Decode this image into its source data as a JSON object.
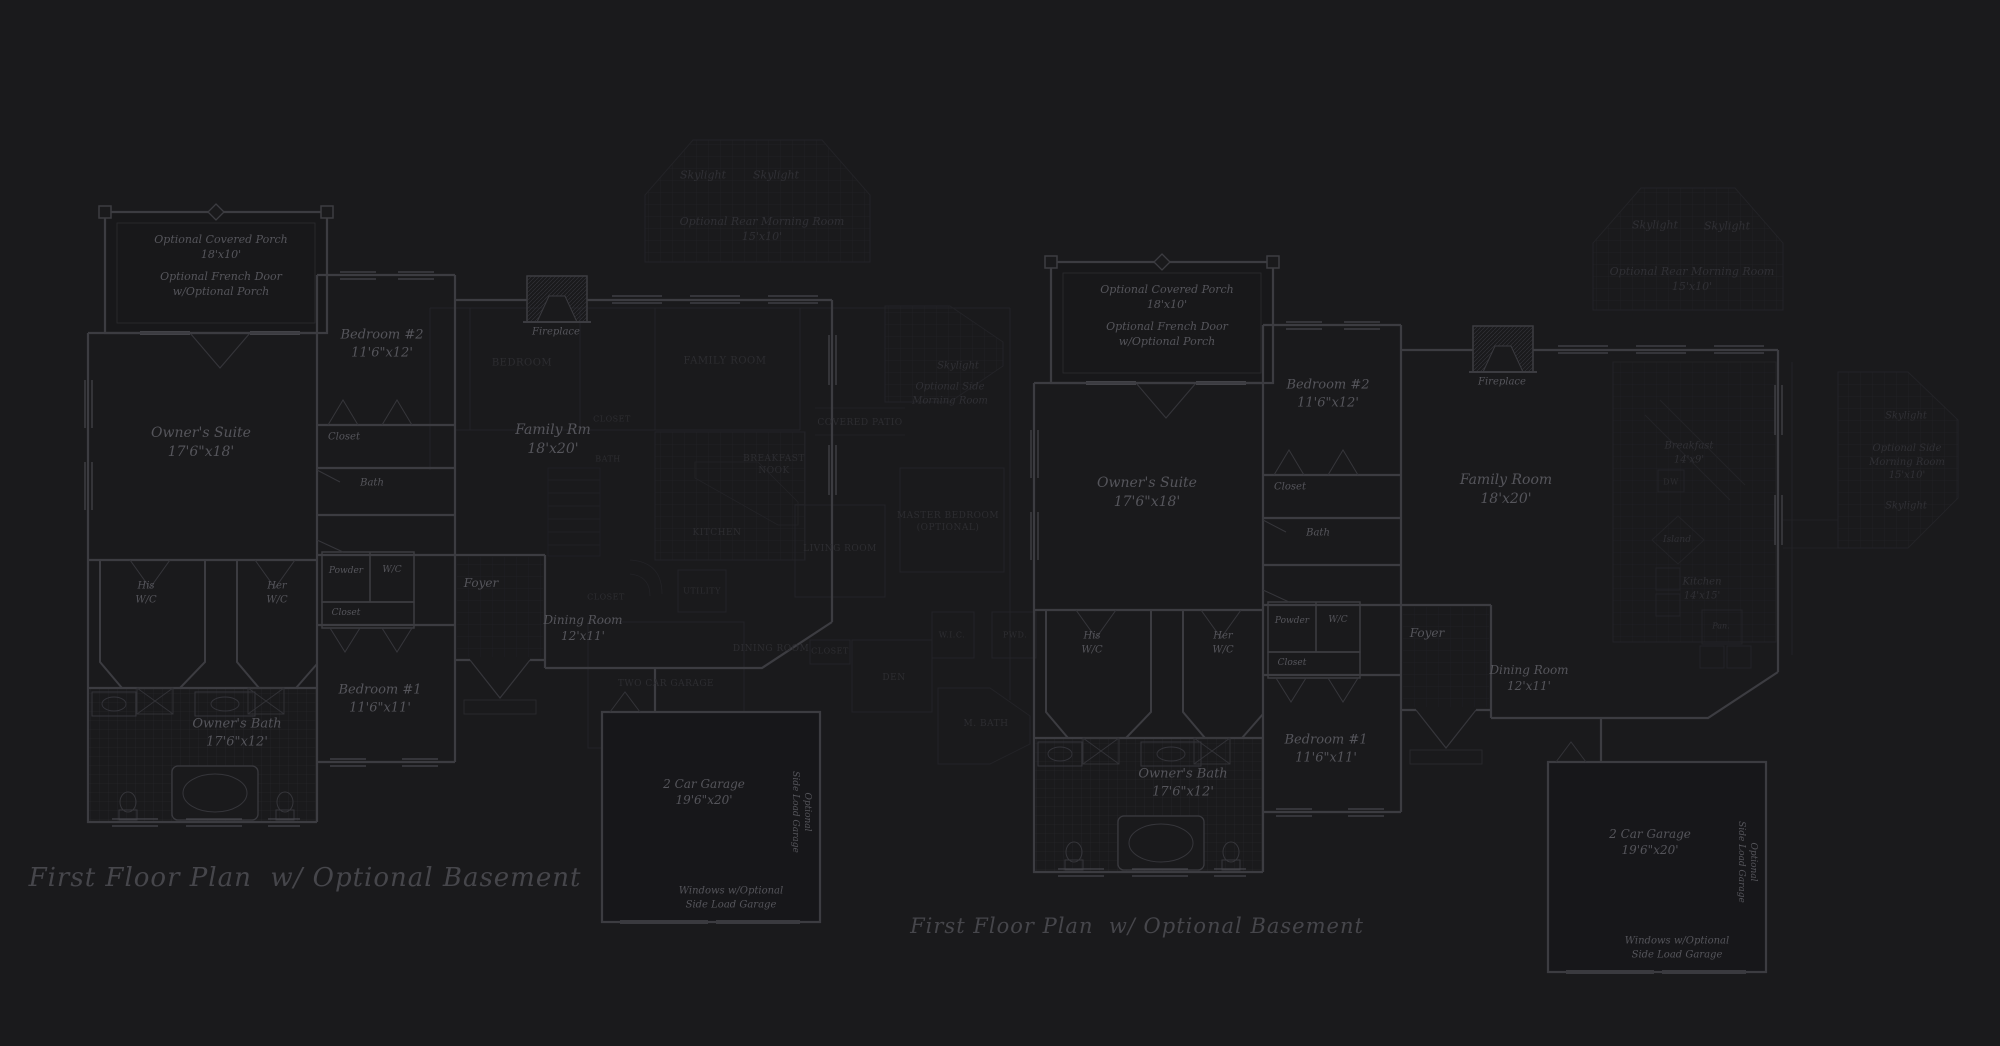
{
  "page": {
    "background": "#1a1a1c",
    "type": "architectural-floor-plan-sheet"
  },
  "colors": {
    "background": "#1a1a1c",
    "wall_bright": "#3c3c41",
    "wall_faint": "#232327",
    "window": "#46464b",
    "tile_bright": "#2a2a2e",
    "tile_faint": "#222226",
    "text_bright": "#55555b",
    "text_faint": "#2d2d31",
    "caption": "#46464b"
  },
  "plans": [
    {
      "id": "left-first-floor-plan",
      "caption": "First Floor Plan  w/ Optional Basement",
      "labels": [
        {
          "text": "Optional Covered Porch\n18'x10'",
          "x": 221,
          "y": 248,
          "s": 11,
          "c": "b"
        },
        {
          "text": "Optional French Door\nw/Optional Porch",
          "x": 221,
          "y": 285,
          "s": 11,
          "c": "b"
        },
        {
          "text": "Bedroom #2\n11'6\"x12'",
          "x": 382,
          "y": 344,
          "s": 13,
          "c": "b"
        },
        {
          "text": "Owner's Suite\n17'6\"x18'",
          "x": 201,
          "y": 443,
          "s": 14,
          "c": "b"
        },
        {
          "text": "Closet",
          "x": 344,
          "y": 437,
          "s": 10,
          "c": "b"
        },
        {
          "text": "Bath",
          "x": 372,
          "y": 483,
          "s": 10,
          "c": "b"
        },
        {
          "text": "Fireplace",
          "x": 556,
          "y": 332,
          "s": 10,
          "c": "b"
        },
        {
          "text": "Family Rm\n18'x20'",
          "x": 553,
          "y": 440,
          "s": 14,
          "c": "b"
        },
        {
          "text": "His\nW/C",
          "x": 146,
          "y": 593,
          "s": 10,
          "c": "b"
        },
        {
          "text": "Her\nW/C",
          "x": 277,
          "y": 593,
          "s": 10,
          "c": "b"
        },
        {
          "text": "Powder",
          "x": 346,
          "y": 571,
          "s": 9,
          "c": "b"
        },
        {
          "text": "W/C",
          "x": 392,
          "y": 570,
          "s": 9,
          "c": "b"
        },
        {
          "text": "Closet",
          "x": 346,
          "y": 613,
          "s": 9,
          "c": "b"
        },
        {
          "text": "Foyer",
          "x": 481,
          "y": 583,
          "s": 12,
          "c": "b"
        },
        {
          "text": "Dining Room\n12'x11'",
          "x": 583,
          "y": 628,
          "s": 12,
          "c": "b"
        },
        {
          "text": "Bedroom #1\n11'6\"x11'",
          "x": 380,
          "y": 699,
          "s": 13,
          "c": "b"
        },
        {
          "text": "Owner's Bath\n17'6\"x12'",
          "x": 237,
          "y": 733,
          "s": 13,
          "c": "b"
        },
        {
          "text": "2 Car Garage\n19'6\"x20'",
          "x": 704,
          "y": 792,
          "s": 12,
          "c": "b"
        },
        {
          "text": "Optional\nSide Load Garage",
          "x": 801,
          "y": 812,
          "s": 9,
          "c": "b",
          "rot": 90
        },
        {
          "text": "Windows w/Optional\nSide Load Garage",
          "x": 731,
          "y": 898,
          "s": 10,
          "c": "b"
        },
        {
          "text": "Skylight",
          "x": 703,
          "y": 176,
          "s": 11,
          "c": "f2"
        },
        {
          "text": "Skylight",
          "x": 776,
          "y": 176,
          "s": 11,
          "c": "f2"
        },
        {
          "text": "Optional Rear Morning Room\n15'x10'",
          "x": 762,
          "y": 230,
          "s": 11,
          "c": "f2"
        },
        {
          "text": "Skylight",
          "x": 958,
          "y": 366,
          "s": 10,
          "c": "f2"
        },
        {
          "text": "Optional Side\nMorning Room",
          "x": 950,
          "y": 394,
          "s": 10,
          "c": "f2"
        },
        {
          "text": "Covered Patio",
          "x": 860,
          "y": 423,
          "s": 9,
          "c": "f"
        },
        {
          "text": "Bedroom",
          "x": 522,
          "y": 363,
          "s": 10,
          "c": "f"
        },
        {
          "text": "Family Room",
          "x": 725,
          "y": 361,
          "s": 10,
          "c": "f"
        },
        {
          "text": "Closet",
          "x": 612,
          "y": 420,
          "s": 8,
          "c": "f"
        },
        {
          "text": "Bath",
          "x": 608,
          "y": 460,
          "s": 8,
          "c": "f"
        },
        {
          "text": "Breakfast\nNook",
          "x": 774,
          "y": 465,
          "s": 9,
          "c": "f"
        },
        {
          "text": "Kitchen",
          "x": 717,
          "y": 533,
          "s": 9,
          "c": "f"
        },
        {
          "text": "Utility",
          "x": 702,
          "y": 592,
          "s": 8,
          "c": "f"
        },
        {
          "text": "Closet",
          "x": 606,
          "y": 598,
          "s": 8,
          "c": "f"
        },
        {
          "text": "Dining Room",
          "x": 771,
          "y": 649,
          "s": 9,
          "c": "f"
        },
        {
          "text": "Two Car Garage",
          "x": 666,
          "y": 684,
          "s": 9,
          "c": "f"
        },
        {
          "text": "Living Room",
          "x": 840,
          "y": 549,
          "s": 9,
          "c": "f"
        },
        {
          "text": "Master Bedroom\n(Optional)",
          "x": 948,
          "y": 522,
          "s": 9,
          "c": "f"
        },
        {
          "text": "W.I.C.",
          "x": 952,
          "y": 636,
          "s": 8,
          "c": "f"
        },
        {
          "text": "Pwd.",
          "x": 1015,
          "y": 636,
          "s": 8,
          "c": "f"
        },
        {
          "text": "Den",
          "x": 894,
          "y": 678,
          "s": 9,
          "c": "f"
        },
        {
          "text": "Closet",
          "x": 830,
          "y": 652,
          "s": 8,
          "c": "f"
        },
        {
          "text": "M. Bath",
          "x": 986,
          "y": 724,
          "s": 9,
          "c": "f"
        }
      ],
      "caption_pos": {
        "x": 305,
        "y": 878,
        "s": 26
      }
    },
    {
      "id": "right-first-floor-plan",
      "caption": "First Floor Plan  w/ Optional Basement",
      "labels": [
        {
          "text": "Optional Covered Porch\n18'x10'",
          "x": 1167,
          "y": 298,
          "s": 11,
          "c": "b"
        },
        {
          "text": "Optional French Door\nw/Optional Porch",
          "x": 1167,
          "y": 335,
          "s": 11,
          "c": "b"
        },
        {
          "text": "Bedroom #2\n11'6\"x12'",
          "x": 1328,
          "y": 394,
          "s": 13,
          "c": "b"
        },
        {
          "text": "Owner's Suite\n17'6\"x18'",
          "x": 1147,
          "y": 493,
          "s": 14,
          "c": "b"
        },
        {
          "text": "Closet",
          "x": 1290,
          "y": 487,
          "s": 10,
          "c": "b"
        },
        {
          "text": "Bath",
          "x": 1318,
          "y": 533,
          "s": 10,
          "c": "b"
        },
        {
          "text": "Fireplace",
          "x": 1502,
          "y": 382,
          "s": 10,
          "c": "b"
        },
        {
          "text": "Family Room\n18'x20'",
          "x": 1506,
          "y": 490,
          "s": 14,
          "c": "b"
        },
        {
          "text": "His\nW/C",
          "x": 1092,
          "y": 643,
          "s": 10,
          "c": "b"
        },
        {
          "text": "Her\nW/C",
          "x": 1223,
          "y": 643,
          "s": 10,
          "c": "b"
        },
        {
          "text": "Powder",
          "x": 1292,
          "y": 621,
          "s": 9,
          "c": "b"
        },
        {
          "text": "W/C",
          "x": 1338,
          "y": 620,
          "s": 9,
          "c": "b"
        },
        {
          "text": "Closet",
          "x": 1292,
          "y": 663,
          "s": 9,
          "c": "b"
        },
        {
          "text": "Foyer",
          "x": 1427,
          "y": 633,
          "s": 12,
          "c": "b"
        },
        {
          "text": "Dining Room\n12'x11'",
          "x": 1529,
          "y": 678,
          "s": 12,
          "c": "b"
        },
        {
          "text": "Bedroom #1\n11'6\"x11'",
          "x": 1326,
          "y": 749,
          "s": 13,
          "c": "b"
        },
        {
          "text": "Owner's Bath\n17'6\"x12'",
          "x": 1183,
          "y": 783,
          "s": 13,
          "c": "b"
        },
        {
          "text": "2 Car Garage\n19'6\"x20'",
          "x": 1650,
          "y": 842,
          "s": 12,
          "c": "b"
        },
        {
          "text": "Optional\nSide Load Garage",
          "x": 1747,
          "y": 862,
          "s": 9,
          "c": "b",
          "rot": 90
        },
        {
          "text": "Windows w/Optional\nSide Load Garage",
          "x": 1677,
          "y": 948,
          "s": 10,
          "c": "b"
        },
        {
          "text": "Skylight",
          "x": 1655,
          "y": 226,
          "s": 11,
          "c": "f2"
        },
        {
          "text": "Skylight",
          "x": 1727,
          "y": 227,
          "s": 11,
          "c": "f2"
        },
        {
          "text": "Optional Rear Morning Room\n15'x10'",
          "x": 1692,
          "y": 280,
          "s": 11,
          "c": "f2"
        },
        {
          "text": "Breakfast\n14'x9'",
          "x": 1689,
          "y": 453,
          "s": 10,
          "c": "f2"
        },
        {
          "text": "DW",
          "x": 1671,
          "y": 483,
          "s": 8,
          "c": "f"
        },
        {
          "text": "Island",
          "x": 1677,
          "y": 540,
          "s": 9,
          "c": "f2"
        },
        {
          "text": "Kitchen\n14'x15'",
          "x": 1702,
          "y": 589,
          "s": 10,
          "c": "f2"
        },
        {
          "text": "Pan.",
          "x": 1721,
          "y": 627,
          "s": 8,
          "c": "f2"
        },
        {
          "text": "Skylight",
          "x": 1906,
          "y": 416,
          "s": 10,
          "c": "f2"
        },
        {
          "text": "Optional Side\nMorning Room\n15'x10'",
          "x": 1907,
          "y": 462,
          "s": 10,
          "c": "f2"
        },
        {
          "text": "Skylight",
          "x": 1906,
          "y": 506,
          "s": 10,
          "c": "f2"
        }
      ],
      "caption_pos": {
        "x": 1137,
        "y": 926,
        "s": 21
      }
    }
  ]
}
